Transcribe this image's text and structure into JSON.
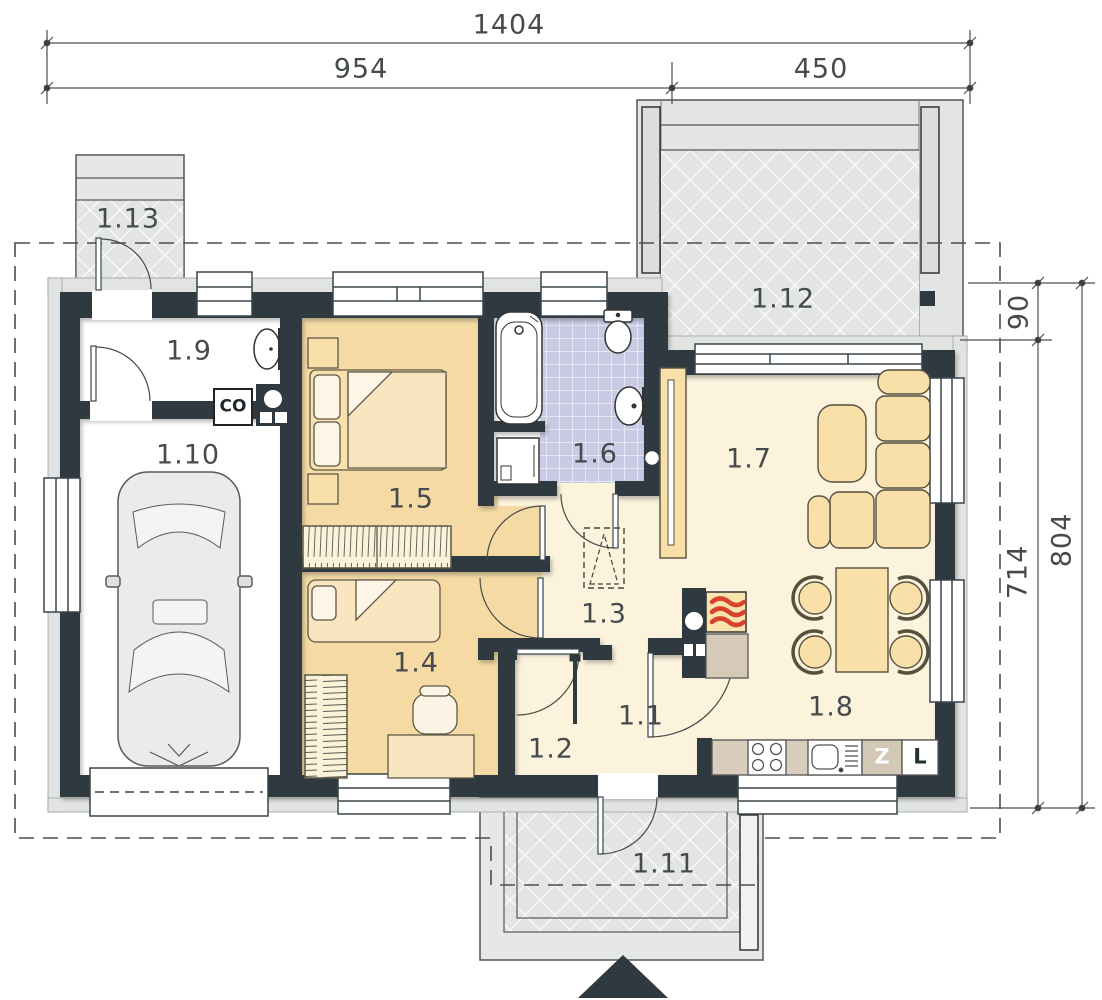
{
  "plan": {
    "room_labels": {
      "r1_1": "1.1",
      "r1_2": "1.2",
      "r1_3": "1.3",
      "r1_4": "1.4",
      "r1_5": "1.5",
      "r1_6": "1.6",
      "r1_7": "1.7",
      "r1_8": "1.8",
      "r1_9": "1.9",
      "r1_10": "1.10",
      "r1_11": "1.11",
      "r1_12": "1.12",
      "r1_13": "1.13"
    },
    "appliance_labels": {
      "boiler": "CO",
      "dishwasher": "Z",
      "fridge": "L"
    },
    "dimensions": {
      "total_width": "1404",
      "left_width": "954",
      "right_width": "450",
      "terrace_depth": "90",
      "house_depth": "714",
      "total_depth": "804"
    },
    "colors": {
      "wall": "#2e3a40",
      "bedroom_floor": "#f5dba3",
      "living_floor": "#fcf3dd",
      "bath_tile": "#c9cbe5",
      "terrace": "#e3e5e5",
      "furniture": "#f9e0a9",
      "flame": "#d8422b"
    }
  }
}
